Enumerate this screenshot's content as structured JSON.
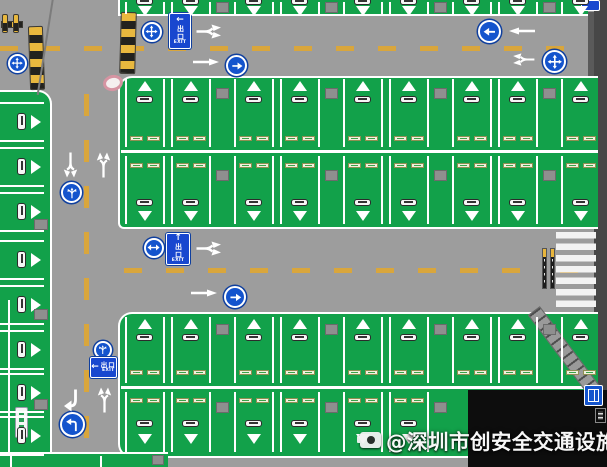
{
  "watermark": {
    "icon": "camera-icon",
    "text": "@深圳市创安全交通设施厂家"
  },
  "signs": {
    "exit_top": {
      "arrow": "←",
      "cn": "出口",
      "en": "EXIT"
    },
    "exit_mid": {
      "arrow": "↑",
      "cn": "出口",
      "en": "EXIT"
    },
    "exit_left": {
      "arrow": "←",
      "cn": "出口",
      "en": "EXIT"
    }
  },
  "icons": {
    "four-way-arrow-icon": "✥",
    "left-arrow-icon": "←",
    "right-arrow-icon": "→",
    "two-way-arrow-icon": "↔",
    "fork-arrow-icon": "⑂",
    "left-turn-arrow-icon": "↰",
    "straight-arrow-icon": "↑",
    "elevator-icon": "◫",
    "camera-icon": "◉"
  },
  "colors": {
    "road": "#9d9d9d",
    "stall_green": "#12a14a",
    "marking_white": "#ffffff",
    "lane_yellow": "#d9a63c",
    "sign_blue": "#1454cd",
    "wall_gray": "#474747",
    "building_black": "#0d0d0d",
    "bollard_yellow": "#e8b53c",
    "marker_pink": "#d694a2"
  }
}
